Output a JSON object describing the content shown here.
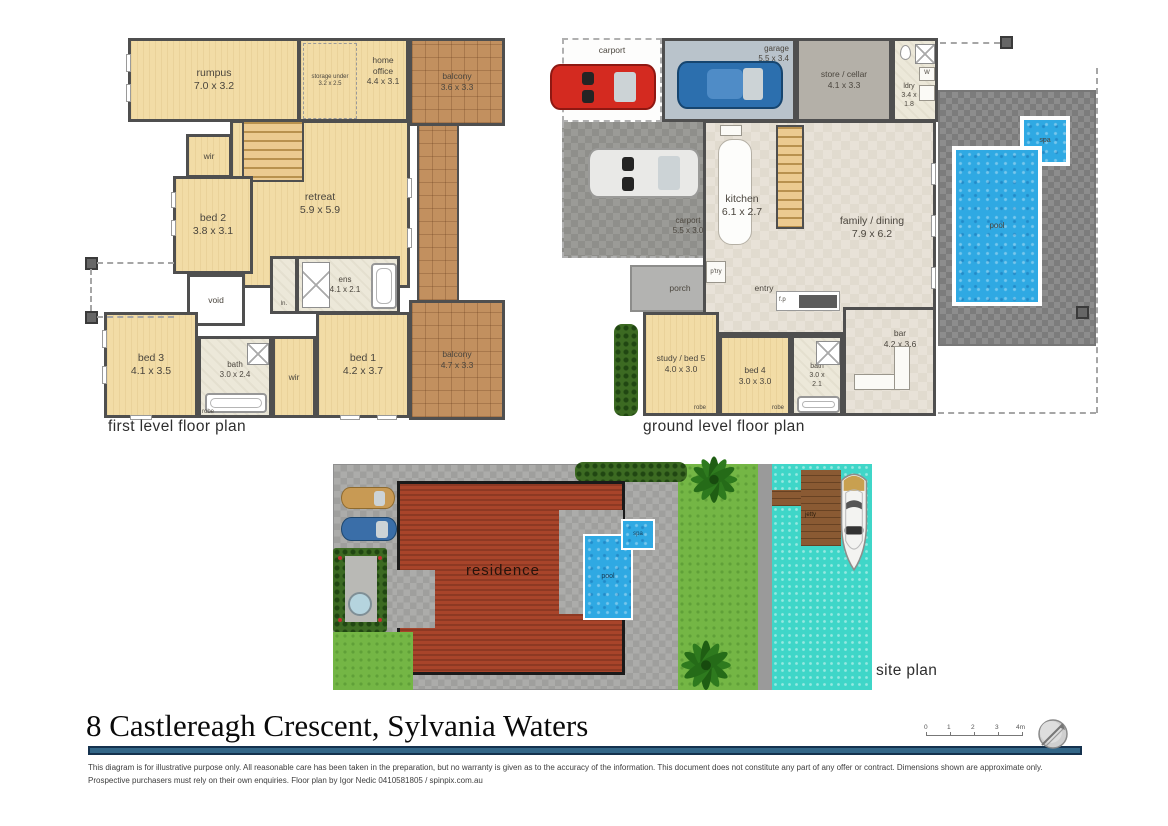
{
  "colors": {
    "wall": "#4f4f4f",
    "timber": "#f2dca6",
    "balcony": "#c2905f",
    "wet": "#ece8d9",
    "living": "#e8e2d8",
    "concrete": "#9b9b97",
    "garage-floor": "#b9c3cb",
    "store-floor": "#b4b0a8",
    "paving": "#8d8d8d",
    "site-paving": "#acacaa",
    "pool": "#2fa9e3",
    "water": "#3fd6c8",
    "grass": "#74b645",
    "roof": "#a8442a",
    "wood": "#8a5a33",
    "bar-blue": "#336687"
  },
  "first_level": {
    "caption": "first level floor plan",
    "rooms": {
      "rumpus": "rumpus\n7.0 x 3.2",
      "storage": "storage under\n3.2 x 2.5",
      "home_office": "home\noffice\n4.4 x 3.1",
      "balcony_top": "balcony\n3.6 x 3.3",
      "wir_top": "wir",
      "retreat": "retreat\n5.9 x 5.9",
      "bed2": "bed 2\n3.8 x 3.1",
      "void": "void",
      "linen": "ln.",
      "ens": "ens\n4.1 x 2.1",
      "bed3": "bed 3\n4.1 x 3.5",
      "bath": "bath\n3.0 x 2.4",
      "wir_lower": "wir",
      "bed1": "bed 1\n4.2 x 3.7",
      "balcony_lower": "balcony\n4.7 x 3.3",
      "robe": "robe"
    }
  },
  "ground_level": {
    "caption": "ground level floor plan",
    "rooms": {
      "carport_rear": "carport",
      "garage": "garage\n5.5 x 3.4",
      "store": "store / cellar\n4.1 x 3.3",
      "ldry": "ldry\n3.4 x\n1.8",
      "washer": "W",
      "carport_front": "carport\n5.5 x 3.0",
      "kitchen": "kitchen\n6.1 x 2.7",
      "pantry": "p'try",
      "family": "family / dining\n7.9 x 6.2",
      "entry": "entry",
      "porch": "porch",
      "fireplace": "f.p",
      "bar": "bar\n4.2 x 3.6",
      "study": "study / bed 5\n4.0 x 3.0",
      "bed4": "bed 4\n3.0 x 3.0",
      "bath": "bath\n3.0 x\n2.1",
      "robe1": "robe",
      "robe2": "robe",
      "pool": "pool",
      "spa": "spa"
    }
  },
  "site_plan": {
    "caption": "site plan",
    "labels": {
      "residence": "residence",
      "pool": "pool",
      "spa": "spa",
      "jetty": "jetty"
    }
  },
  "footer": {
    "title": "8 Castlereagh Crescent, Sylvania Waters",
    "disclaimer": "This diagram is for illustrative purpose only. All reasonable care has been taken in the preparation, but no warranty is given as to the accuracy of the information. This document does not constitute any part of any offer or contract. Dimensions shown are approximate only. Prospective purchasers must rely on their own enquiries. Floor plan by Igor Nedic 0410581805 / spinpix.com.au",
    "scale_ticks": [
      "0",
      "1",
      "2",
      "3",
      "4m"
    ]
  }
}
